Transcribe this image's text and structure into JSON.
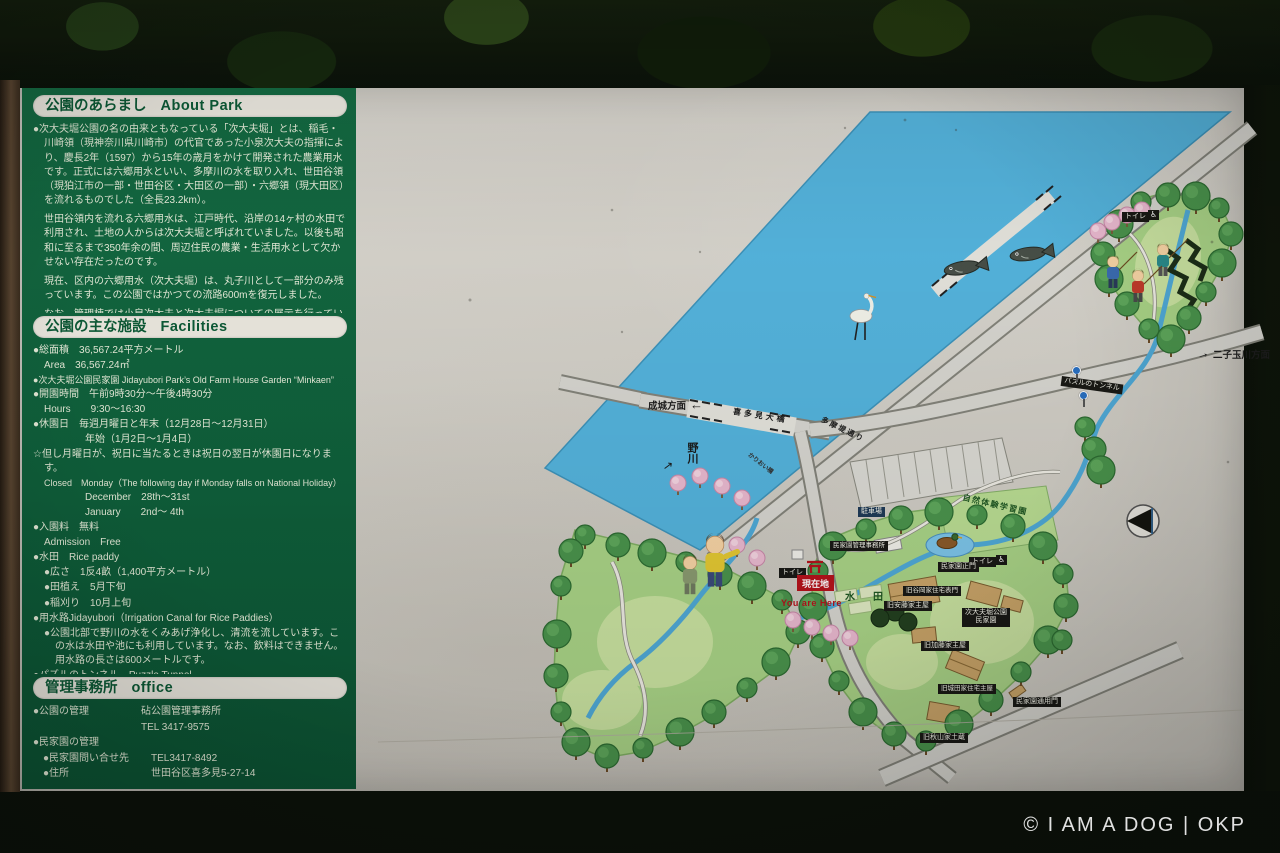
{
  "watermark": "© I AM A DOG | OKP",
  "panel": {
    "about": {
      "title_ja": "公園のあらまし",
      "title_en": "About Park",
      "p1": "●次大夫堀公園の名の由来ともなっている「次大夫堀」とは、稲毛・川崎領（現神奈川県川崎市）の代官であった小泉次大夫の指揮により、慶長2年（1597）から15年の歳月をかけて開発された農業用水です。正式には六郷用水といい、多摩川の水を取り入れ、世田谷領（現狛江市の一部・世田谷区・大田区の一部）・六郷領（現大田区）を流れるものでした（全長23.2km）。",
      "p2": "世田谷領内を流れる六郷用水は、江戸時代、沿岸の14ヶ村の水田で利用され、土地の人からは次大夫堀と呼ばれていました。以後も昭和に至るまで350年余の間、周辺住民の農業・生活用水として欠かせない存在だったのです。",
      "p3": "現在、区内の六郷用水（次大夫堀）は、丸子川として一部分のみ残っています。この公園ではかつての流路600mを復元しました。",
      "p4": "なお、管理棟では小泉次大夫と次大夫堀についての展示を行っています。"
    },
    "facilities": {
      "title_ja": "公園の主な施設",
      "title_en": "Facilities",
      "lines": [
        "●総面積　36,567.24平方メートル",
        "Area　36,567.24㎡",
        "●次大夫堀公園民家園 Jidayubori Park’s Old Farm House Garden “Minkaen”",
        "●開園時間　午前9時30分～午後4時30分",
        "Hours　　9:30～16:30",
        "●休園日　毎週月曜日と年末（12月28日～12月31日）",
        "年始（1月2日～1月4日）",
        "☆但し月曜日が、祝日に当たるときは祝日の翌日が休園日になります。",
        "Closed　Monday（The following day if Monday falls on National Holiday）",
        "December　28th～31st",
        "January　　2nd～ 4th",
        "●入園料　無料",
        "Admission　Free",
        "●水田　Rice paddy",
        "●広さ　1反4畝（1,400平方メートル）",
        "●田植え　5月下旬",
        "●稲刈り　10月上旬",
        "●用水路Jidayubori（Irrigation Canal for Rice Paddies）",
        "●公園北部で野川の水をくみあげ浄化し、清流を流しています。この水は水田や池にも利用しています。なお、飲料はできません。用水路の長さは600メートルです。",
        "●パズルのトンネル　Puzzle Tunnel",
        "●卵型のパズルが各種の鳥に変化する壁画のある不思議なトンネルです。"
      ]
    },
    "office": {
      "title_ja": "管理事務所",
      "title_en": "office",
      "rows": [
        {
          "label": "●公園の管理",
          "value": "砧公園管理事務所"
        },
        {
          "label": "",
          "value": "TEL 3417-9575"
        },
        {
          "label": "●民家園の管理",
          "value": ""
        },
        {
          "label": "●民家園問い合せ先",
          "value": "TEL3417-8492"
        },
        {
          "label": "●住所",
          "value": "世田谷区喜多見5-27-14"
        },
        {
          "label": "Address",
          "value": "5-27-14,Kitami,Setagaya-ku,Tokyo"
        }
      ]
    }
  },
  "map": {
    "river": "野川",
    "arrow_ne": "↗",
    "arrow_left": "←",
    "arrow_right": "→",
    "dir_seijo": "成城方面",
    "dir_futako": "二子玉川方面",
    "road_kitami_bridge": "喜多見大橋",
    "road_tamazutsumi": "多摩堤通り",
    "bridge_small": "かりおい橋",
    "labels": {
      "toilet": "トイレ",
      "wheelchair": "♿",
      "here_ja": "現在地",
      "here_en": "You are Here",
      "paddy": "水　田",
      "parking": "駐車場",
      "tunnel": "パズルのトンネル",
      "nature_garden": "自然体験学習園",
      "office": "民家園管理事務所",
      "main_gate": "民家園正門",
      "minkaen_1": "次大夫堀公園",
      "minkaen_2": "民家園",
      "b_omotemon": "旧谷岡家住宅表門",
      "b_ando": "旧安藤家主屋",
      "b_kato": "旧加藤家主屋",
      "b_shirota": "旧城田家住宅主屋",
      "b_akiyama": "旧秋山家土蔵",
      "side_gate": "民家園通用門"
    }
  }
}
